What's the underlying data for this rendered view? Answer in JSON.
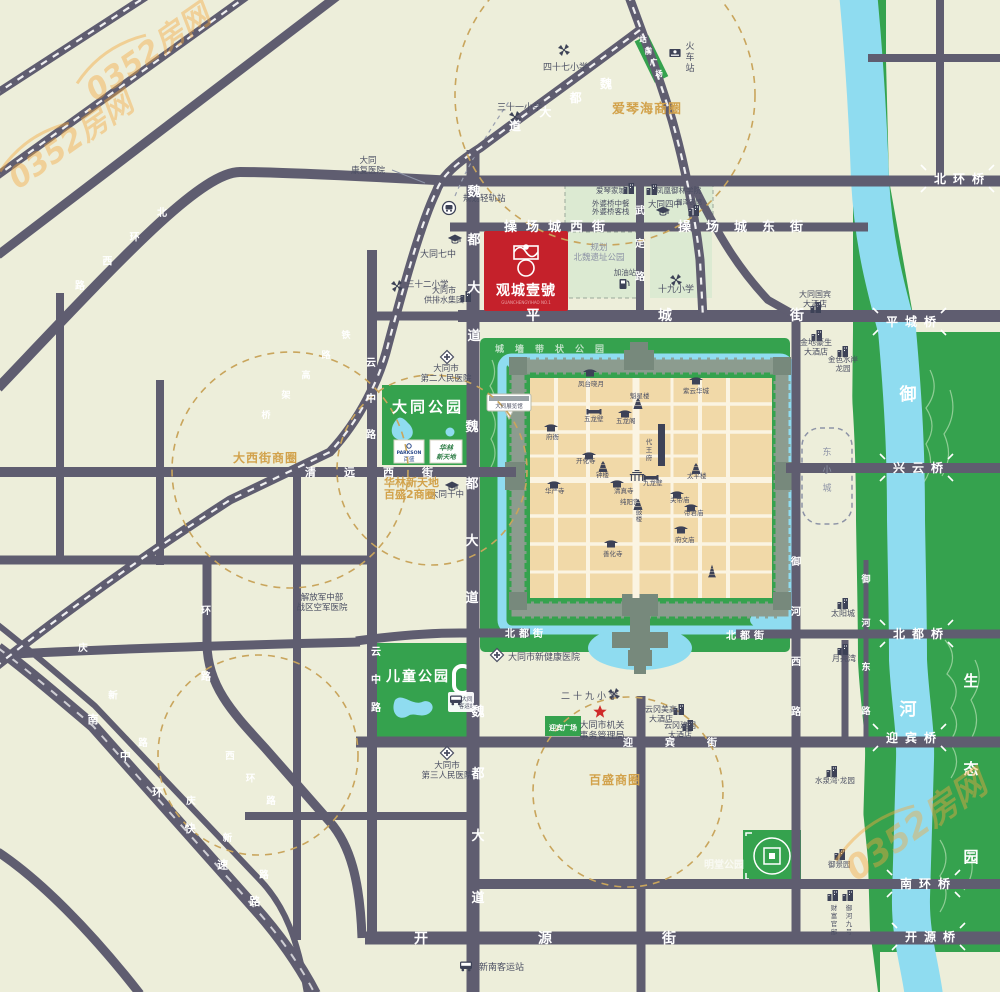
{
  "project": {
    "name": "观城壹號",
    "latin": "GUANCHENGYIHAO NO.1"
  },
  "watermark": "0352房网",
  "colors": {
    "bg": "#edeeda",
    "road": "#5f5d70",
    "green": "#35a24e",
    "pale_green": "#dcead2",
    "water": "#8fdcf0",
    "block_tan": "#f1d9a8",
    "wall": "#8c9c8f",
    "icon_navy": "#3d4257",
    "project_red": "#c5212b",
    "gold": "#d2a24b",
    "dashed_circle": "#c9a55c",
    "text": "#4b4f63",
    "gray": "#8d93a6",
    "orange": "#f5a93e"
  },
  "commercial_circles": [
    "爱琴海商圈",
    "大西街商圈",
    "华林新天地百盛2商圈",
    "百盛商圈"
  ],
  "map": {
    "labels": [
      {
        "t": "四十七小学",
        "x": 543,
        "y": 70,
        "s": 9,
        "c": "dk"
      },
      {
        "t": "三十一小学",
        "x": 497,
        "y": 110,
        "s": 9,
        "c": "dk"
      },
      {
        "t": [
          "大同",
          "康复医院"
        ],
        "x": 368,
        "y": 163,
        "s": 8.5,
        "c": "dk",
        "a": "m"
      },
      {
        "t": "规划轻轨站",
        "x": 463,
        "y": 201,
        "s": 8.5,
        "c": "dk"
      },
      {
        "t": "大同七中",
        "x": 420,
        "y": 257,
        "s": 9,
        "c": "dk"
      },
      {
        "t": "三十二小学",
        "x": 406,
        "y": 287,
        "s": 8.5,
        "c": "dk"
      },
      {
        "t": [
          "大同市",
          "供排水集团"
        ],
        "x": 444,
        "y": 293,
        "s": 8,
        "c": "dk",
        "a": "m"
      },
      {
        "t": [
          "规划",
          "北魏遗址公园"
        ],
        "x": 599,
        "y": 250,
        "s": 8.5,
        "c": "gy",
        "a": "m"
      },
      {
        "t": "加油站",
        "x": 625,
        "y": 275,
        "s": 7.5,
        "c": "dk",
        "a": "m"
      },
      {
        "t": "十九小学",
        "x": 676,
        "y": 292,
        "s": 9,
        "c": "dk",
        "a": "m"
      },
      {
        "t": "爱琴家城",
        "x": 596,
        "y": 193,
        "s": 7.5,
        "c": "dk"
      },
      {
        "t": "外婆桥中餐",
        "x": 592,
        "y": 206,
        "s": 7.5,
        "c": "dk"
      },
      {
        "t": "外婆桥客栈",
        "x": 592,
        "y": 214,
        "s": 7.5,
        "c": "dk"
      },
      {
        "t": "凤凰御林学院",
        "x": 656,
        "y": 193,
        "s": 7.5,
        "c": "dk"
      },
      {
        "t": "大同四中",
        "x": 648,
        "y": 207,
        "s": 8.5,
        "c": "dk"
      },
      {
        "t": "润泽农馆",
        "x": 676,
        "y": 204,
        "s": 6.5,
        "c": "dk"
      },
      {
        "t": [
          "大同国宾",
          "大酒店"
        ],
        "x": 815,
        "y": 297,
        "s": 8,
        "c": "dk",
        "a": "m"
      },
      {
        "t": [
          "金地豪生",
          "大酒店"
        ],
        "x": 816,
        "y": 345,
        "s": 8,
        "c": "dk",
        "a": "m"
      },
      {
        "t": [
          "金色水岸",
          "龙园"
        ],
        "x": 843,
        "y": 362,
        "s": 7.5,
        "c": "dk",
        "a": "m"
      },
      {
        "t": "太阳城",
        "x": 843,
        "y": 616,
        "s": 8,
        "c": "dk",
        "a": "m"
      },
      {
        "t": "月亮湾",
        "x": 844,
        "y": 661,
        "s": 8,
        "c": "dk",
        "a": "m"
      },
      {
        "t": "水泉湾·龙园",
        "x": 835,
        "y": 783,
        "s": 7.5,
        "c": "dk",
        "a": "m"
      },
      {
        "t": [
          "云冈美高",
          "大酒店"
        ],
        "x": 661,
        "y": 712,
        "s": 8,
        "c": "dk",
        "a": "m"
      },
      {
        "t": [
          "云冈建国",
          "大酒店"
        ],
        "x": 680,
        "y": 728,
        "s": 8,
        "c": "dk",
        "a": "m"
      },
      {
        "t": [
          "大同市机关",
          "事务管理局"
        ],
        "x": 602,
        "y": 728,
        "s": 9,
        "c": "dk",
        "a": "m"
      },
      {
        "t": "二十九小学",
        "x": 561,
        "y": 699,
        "s": 9,
        "c": "dk",
        "ls": 3
      },
      {
        "t": "大同市新健康医院",
        "x": 508,
        "y": 660,
        "s": 9,
        "c": "dk"
      },
      {
        "t": [
          "大同市",
          "第三人民医院"
        ],
        "x": 447,
        "y": 768,
        "s": 8.5,
        "c": "dk",
        "a": "m"
      },
      {
        "t": [
          "解放军中部",
          "战区空军医院"
        ],
        "x": 322,
        "y": 600,
        "s": 8.5,
        "c": "dk",
        "a": "m"
      },
      {
        "t": [
          "大同市",
          "第二人民医院"
        ],
        "x": 446,
        "y": 371,
        "s": 8.5,
        "c": "dk",
        "a": "m"
      },
      {
        "t": "大同十中",
        "x": 430,
        "y": 497,
        "s": 8.5,
        "c": "dk"
      },
      {
        "t": "新南客运站",
        "x": 479,
        "y": 970,
        "s": 9,
        "c": "dk"
      },
      {
        "t": "明堂公园",
        "x": 704,
        "y": 868,
        "s": 10,
        "c": "wt70"
      },
      {
        "t": "御景园",
        "x": 828,
        "y": 867,
        "s": 7.5,
        "c": "dk"
      },
      {
        "t": [
          "大同",
          "客运站"
        ],
        "x": 467,
        "y": 701,
        "s": 5.5,
        "c": "dk",
        "a": "m"
      },
      {
        "t": "大同展览馆",
        "x": 509,
        "y": 408,
        "s": 5.5,
        "c": "dk",
        "a": "m"
      },
      {
        "t": "迎宾广场",
        "x": 563,
        "y": 730,
        "s": 7,
        "c": "wt",
        "a": "m"
      },
      {
        "t": "大同公园",
        "x": 428,
        "y": 412,
        "s": 15,
        "c": "wt",
        "a": "m",
        "ls": 3
      },
      {
        "t": "儿童公园",
        "x": 418,
        "y": 681,
        "s": 14,
        "c": "wt",
        "a": "m",
        "ls": 2
      },
      {
        "t": "城墙带状公园",
        "x": 495,
        "y": 352,
        "s": 9,
        "c": "wt70",
        "ls": 11
      },
      {
        "t": "爱琴海商圈",
        "x": 612,
        "y": 113,
        "s": 13,
        "c": "gold",
        "ls": 1
      },
      {
        "t": "大西街商圈",
        "x": 233,
        "y": 462,
        "s": 12,
        "c": "gold",
        "ls": 1
      },
      {
        "t": "华林新天地",
        "x": 384,
        "y": 486,
        "s": 11,
        "c": "gold"
      },
      {
        "t": "百盛2商圈",
        "x": 384,
        "y": 498,
        "s": 11,
        "c": "gold"
      },
      {
        "t": "百盛商圈",
        "x": 589,
        "y": 784,
        "s": 12,
        "c": "gold",
        "ls": 1
      },
      {
        "t": "操场城西街",
        "x": 504,
        "y": 231,
        "s": 13,
        "c": "rl",
        "ls": 9
      },
      {
        "t": "操场城东街",
        "x": 678,
        "y": 231,
        "s": 13,
        "c": "rl",
        "ls": 15
      },
      {
        "t": "平城街",
        "x": 526,
        "y": 320,
        "s": 14,
        "c": "rl",
        "ls": 118
      },
      {
        "t": "开源街",
        "x": 414,
        "y": 943,
        "s": 14,
        "c": "rl",
        "ls": 110
      },
      {
        "t": "北都街",
        "x": 505,
        "y": 637,
        "s": 10,
        "c": "rl",
        "ls": 4
      },
      {
        "t": "北都街",
        "x": 726,
        "y": 639,
        "s": 10,
        "c": "rl",
        "ls": 4
      },
      {
        "t": "迎宾街",
        "x": 623,
        "y": 746,
        "s": 10,
        "c": "rl",
        "ls": 32
      },
      {
        "t": "清远西街",
        "x": 305,
        "y": 476,
        "s": 11,
        "c": "rl",
        "ls": 28
      },
      {
        "t": "凤台晓月",
        "x": 578,
        "y": 386,
        "s": 6.5,
        "c": "dk"
      },
      {
        "t": "魁星楼",
        "x": 630,
        "y": 398,
        "s": 6.5,
        "c": "dk"
      },
      {
        "t": "紫云华城",
        "x": 683,
        "y": 393,
        "s": 6.5,
        "c": "dk"
      },
      {
        "t": "五龙壁",
        "x": 584,
        "y": 421,
        "s": 6.5,
        "c": "dk"
      },
      {
        "t": "五龙阁",
        "x": 616,
        "y": 423,
        "s": 6.5,
        "c": "dk"
      },
      {
        "t": "府衙",
        "x": 546,
        "y": 439,
        "s": 6.5,
        "c": "dk"
      },
      {
        "t": "开化寺",
        "x": 576,
        "y": 463,
        "s": 6.5,
        "c": "dk"
      },
      {
        "t": "钟楼",
        "x": 596,
        "y": 477,
        "s": 6.5,
        "c": "dk"
      },
      {
        "t": "九龙壁",
        "x": 643,
        "y": 485,
        "s": 6.5,
        "c": "dk"
      },
      {
        "t": "太平楼",
        "x": 687,
        "y": 478,
        "s": 6.5,
        "c": "dk"
      },
      {
        "t": "清真寺",
        "x": 614,
        "y": 493,
        "s": 6.5,
        "c": "dk"
      },
      {
        "t": "华严寺",
        "x": 545,
        "y": 493,
        "s": 6.5,
        "c": "dk"
      },
      {
        "t": "纯阳宫",
        "x": 620,
        "y": 504,
        "s": 6.5,
        "c": "dk"
      },
      {
        "t": "关帝庙",
        "x": 670,
        "y": 502,
        "s": 6.5,
        "c": "dk"
      },
      {
        "t": "帝君庙",
        "x": 684,
        "y": 515,
        "s": 6.5,
        "c": "dk"
      },
      {
        "t": "府文庙",
        "x": 675,
        "y": 542,
        "s": 6.5,
        "c": "dk"
      },
      {
        "t": "善化寺",
        "x": 603,
        "y": 556,
        "s": 6.5,
        "c": "dk"
      }
    ],
    "vlabels": [
      {
        "t": "魏都大道",
        "x": 474,
        "y": 196,
        "g": 48,
        "s": 13,
        "c": "rl"
      },
      {
        "t": "魏都大道",
        "x": 472,
        "y": 431,
        "g": 57,
        "s": 13,
        "c": "rl"
      },
      {
        "t": "魏都大道",
        "x": 478,
        "y": 716,
        "g": 62,
        "s": 13,
        "c": "rl"
      },
      {
        "t": "武定路",
        "x": 640,
        "y": 214,
        "g": 33,
        "s": 10,
        "c": "rl"
      },
      {
        "t": "云中路",
        "x": 371,
        "y": 366,
        "g": 36,
        "s": 10,
        "c": "rl"
      },
      {
        "t": "云中路",
        "x": 376,
        "y": 655,
        "g": 28,
        "s": 10,
        "c": "rl"
      },
      {
        "t": "御河西路",
        "x": 796,
        "y": 565,
        "g": 50,
        "s": 10,
        "c": "rl"
      },
      {
        "t": "御河东路",
        "x": 866,
        "y": 582,
        "g": 44,
        "s": 9,
        "c": "rl"
      },
      {
        "t": "环路",
        "x": 206,
        "y": 614,
        "g": 66,
        "s": 10,
        "c": "rl"
      },
      {
        "t": "火车站",
        "x": 690,
        "y": 49,
        "g": 11,
        "s": 9,
        "c": "dk"
      },
      {
        "t": "东小城",
        "x": 827,
        "y": 455,
        "g": 18,
        "s": 9,
        "c": "gy"
      },
      {
        "t": "财富官邸",
        "x": 834,
        "y": 910,
        "g": 8,
        "s": 6.5,
        "c": "dk"
      },
      {
        "t": "御河九号",
        "x": 849,
        "y": 910,
        "g": 8,
        "s": 6.5,
        "c": "dk"
      },
      {
        "t": "代王府",
        "x": 649,
        "y": 444,
        "g": 8,
        "s": 6.5,
        "c": "dk"
      },
      {
        "t": "鼓楼",
        "x": 639,
        "y": 514,
        "g": 7,
        "s": 6.5,
        "c": "dk"
      },
      {
        "t": "生态园",
        "x": 971,
        "y": 686,
        "g": 88,
        "s": 15,
        "c": "wt"
      },
      {
        "t": "御河",
        "x": 908,
        "y": 400,
        "g": 315,
        "s": 17,
        "c": "wt"
      }
    ],
    "dlabels": [
      {
        "t": "魏都大道",
        "x1": 606,
        "y1": 88,
        "x2": 515,
        "y2": 130,
        "s": 12,
        "c": "rl"
      },
      {
        "t": "站前广场",
        "x1": 643,
        "y1": 42,
        "x2": 659,
        "y2": 76,
        "s": 7.5,
        "c": "wt"
      },
      {
        "t": "北环西路",
        "x1": 162,
        "y1": 216,
        "x2": 80,
        "y2": 289,
        "s": 10,
        "c": "rl"
      },
      {
        "t": "南中环快速路",
        "x1": 93,
        "y1": 723,
        "x2": 255,
        "y2": 905,
        "s": 11,
        "c": "rl"
      },
      {
        "t": "庆新路",
        "x1": 83,
        "y1": 651,
        "x2": 143,
        "y2": 746,
        "s": 9.5,
        "c": "rl"
      },
      {
        "t": "庆新路",
        "x1": 191,
        "y1": 804,
        "x2": 264,
        "y2": 878,
        "s": 9.5,
        "c": "rl"
      },
      {
        "t": "西环路",
        "x1": 230,
        "y1": 759,
        "x2": 271,
        "y2": 804,
        "s": 9.5,
        "c": "rl"
      },
      {
        "t": "铁路高架桥",
        "x1": 346,
        "y1": 338,
        "x2": 266,
        "y2": 418,
        "s": 9,
        "c": "rl"
      }
    ],
    "bridges": [
      {
        "t": "北环桥",
        "x": 934,
        "y": 183
      },
      {
        "t": "平城桥",
        "x": 886,
        "y": 326
      },
      {
        "t": "兴云桥",
        "x": 893,
        "y": 472
      },
      {
        "t": "北都桥",
        "x": 893,
        "y": 638
      },
      {
        "t": "迎宾桥",
        "x": 886,
        "y": 742
      },
      {
        "t": "南环桥",
        "x": 900,
        "y": 888
      },
      {
        "t": "开源桥",
        "x": 905,
        "y": 941
      }
    ],
    "dashed_circles": [
      {
        "cx": 605,
        "cy": 95,
        "r": 150
      },
      {
        "cx": 290,
        "cy": 470,
        "r": 118
      },
      {
        "cx": 432,
        "cy": 470,
        "r": 95
      },
      {
        "cx": 628,
        "cy": 792,
        "r": 95
      },
      {
        "cx": 258,
        "cy": 755,
        "r": 100
      }
    ],
    "icons": [
      {
        "k": "kite",
        "x": 564,
        "y": 50
      },
      {
        "k": "kite",
        "x": 515,
        "y": 117
      },
      {
        "k": "kite",
        "x": 397,
        "y": 286
      },
      {
        "k": "kite",
        "x": 676,
        "y": 280
      },
      {
        "k": "kite",
        "x": 614,
        "y": 694
      },
      {
        "k": "cap",
        "x": 455,
        "y": 240
      },
      {
        "k": "cap",
        "x": 663,
        "y": 212
      },
      {
        "k": "cap",
        "x": 452,
        "y": 487
      },
      {
        "k": "cross",
        "x": 447,
        "y": 357
      },
      {
        "k": "cross",
        "x": 497,
        "y": 655
      },
      {
        "k": "cross",
        "x": 447,
        "y": 753
      },
      {
        "k": "star",
        "x": 600,
        "y": 712
      },
      {
        "k": "fuel",
        "x": 624,
        "y": 284
      },
      {
        "k": "metro",
        "x": 449,
        "y": 208
      },
      {
        "k": "train",
        "x": 675,
        "y": 53
      },
      {
        "k": "bus",
        "x": 466,
        "y": 966
      },
      {
        "k": "bus",
        "x": 456,
        "y": 700
      },
      {
        "k": "bldg",
        "x": 816,
        "y": 308
      },
      {
        "k": "bldg",
        "x": 817,
        "y": 336
      },
      {
        "k": "bldg",
        "x": 843,
        "y": 352
      },
      {
        "k": "bldg",
        "x": 843,
        "y": 604
      },
      {
        "k": "bldg",
        "x": 843,
        "y": 650
      },
      {
        "k": "bldg",
        "x": 832,
        "y": 772
      },
      {
        "k": "bldg",
        "x": 679,
        "y": 710
      },
      {
        "k": "bldg",
        "x": 688,
        "y": 726
      },
      {
        "k": "bldg",
        "x": 629,
        "y": 189
      },
      {
        "k": "bldg",
        "x": 652,
        "y": 190
      },
      {
        "k": "bldg",
        "x": 694,
        "y": 211
      },
      {
        "k": "bldg",
        "x": 466,
        "y": 297
      },
      {
        "k": "bldg",
        "x": 840,
        "y": 855
      },
      {
        "k": "bldg",
        "x": 833,
        "y": 896
      },
      {
        "k": "bldg",
        "x": 848,
        "y": 896
      },
      {
        "k": "temple",
        "x": 551,
        "y": 428
      },
      {
        "k": "temple",
        "x": 590,
        "y": 373
      },
      {
        "k": "temple",
        "x": 696,
        "y": 381
      },
      {
        "k": "temple",
        "x": 625,
        "y": 414
      },
      {
        "k": "temple",
        "x": 554,
        "y": 485
      },
      {
        "k": "temple",
        "x": 617,
        "y": 484
      },
      {
        "k": "temple",
        "x": 677,
        "y": 495
      },
      {
        "k": "temple",
        "x": 691,
        "y": 508
      },
      {
        "k": "temple",
        "x": 681,
        "y": 530
      },
      {
        "k": "temple",
        "x": 611,
        "y": 544
      },
      {
        "k": "temple",
        "x": 589,
        "y": 456
      },
      {
        "k": "wall",
        "x": 594,
        "y": 412
      },
      {
        "k": "wall",
        "x": 651,
        "y": 478
      },
      {
        "k": "gate",
        "x": 637,
        "y": 477
      },
      {
        "k": "tower",
        "x": 603,
        "y": 467
      },
      {
        "k": "tower",
        "x": 696,
        "y": 469
      },
      {
        "k": "tower",
        "x": 638,
        "y": 404
      },
      {
        "k": "tower",
        "x": 638,
        "y": 505
      },
      {
        "k": "pagoda",
        "x": 712,
        "y": 571
      }
    ],
    "watermarks": [
      {
        "x": 95,
        "y": 102,
        "r": -35,
        "s": 30
      },
      {
        "x": 18,
        "y": 190,
        "r": -35,
        "s": 30
      },
      {
        "x": 856,
        "y": 882,
        "r": -35,
        "s": 34
      }
    ]
  }
}
